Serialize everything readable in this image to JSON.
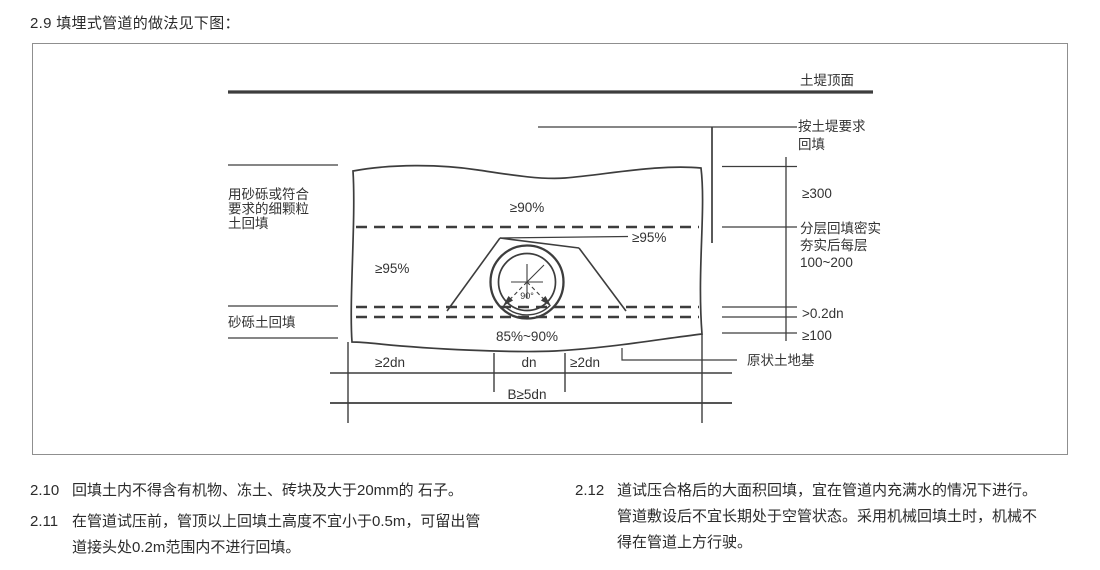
{
  "page": {
    "heading": "2.9 填埋式管道的做法见下图："
  },
  "diagram": {
    "right_labels": {
      "embankment_top": "土堤顶面",
      "backfill_req_1": "按土堤要求",
      "backfill_req_2": "回填",
      "dim_300": "≥300",
      "layered_1": "分层回填密实",
      "layered_2": "夯实后每层",
      "layered_3": "100~200",
      "dim_02dn": ">0.2dn",
      "dim_100": "≥100",
      "undisturbed": "原状土地基"
    },
    "left_labels": {
      "fine_soil_1": "用砂砾或符合",
      "fine_soil_2": "要求的细颗粒",
      "fine_soil_3": "土回填",
      "gravel": "砂砾土回填"
    },
    "compaction": {
      "top": "≥90%",
      "left": "≥95%",
      "haunch": "≥95%",
      "bottom": "85%~90%"
    },
    "pipe": {
      "angle": "90°"
    },
    "dims_bottom": {
      "left": "≥2dn",
      "mid": "dn",
      "right": "≥2dn",
      "total": "B≥5dn"
    }
  },
  "notes": {
    "items": [
      {
        "num": "2.10",
        "lines": [
          "回填土内不得含有机物、冻土、砖块及大于20mm的 石子。"
        ]
      },
      {
        "num": "2.11",
        "lines": [
          "在管道试压前，管顶以上回填土高度不宜小于0.5m，可留出管",
          "道接头处0.2m范围内不进行回填。"
        ]
      },
      {
        "num": "2.12",
        "lines": [
          "道试压合格后的大面积回填，宜在管道内充满水的情况下进行。",
          "管道敷设后不宜长期处于空管状态。采用机械回填土时，机械不",
          "得在管道上方行驶。"
        ]
      }
    ]
  },
  "colors": {
    "line": "#3d3d3d",
    "border": "#8f8f8f",
    "text": "#2b2b2b"
  }
}
